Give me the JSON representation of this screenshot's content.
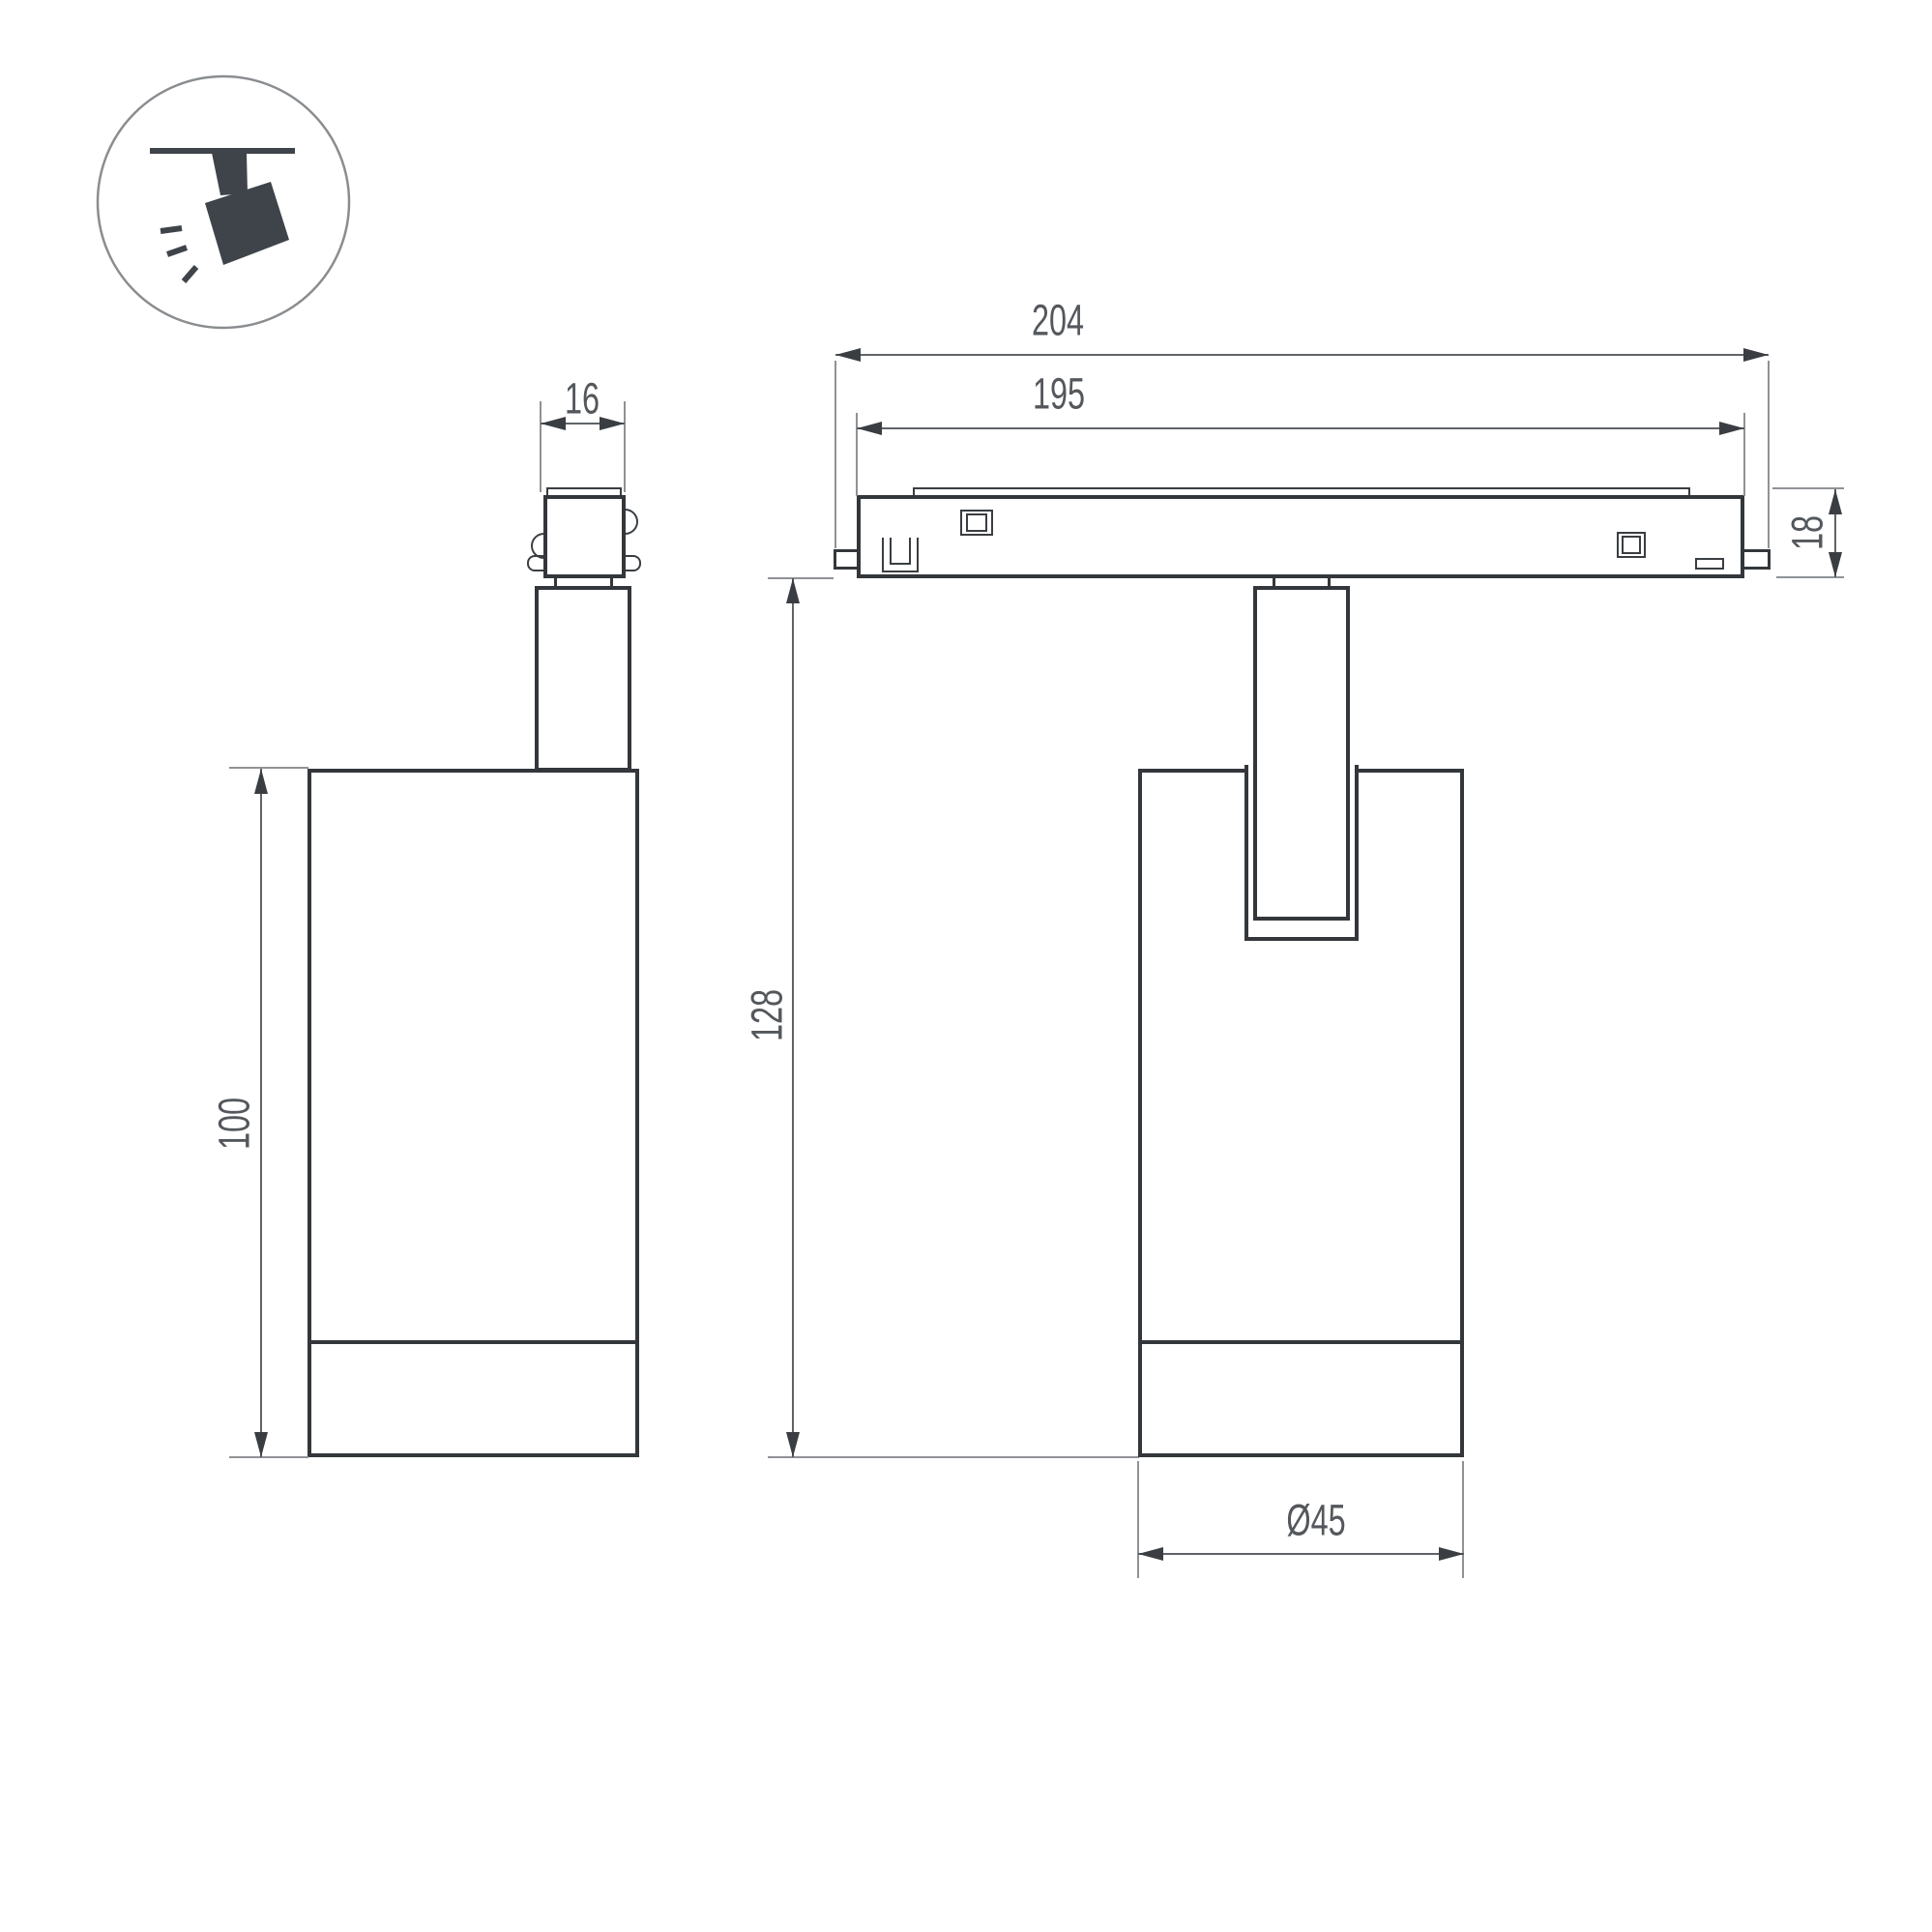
{
  "drawing": {
    "type": "luminaire-dimension-drawing",
    "views": [
      "side-view",
      "front-view-on-track"
    ]
  },
  "icon": {
    "name": "track-spotlight-icon",
    "description": "ceiling track with tilted spotlight emitting light"
  },
  "dims": {
    "adapter_width": "16",
    "body_height": "100",
    "track_total_length": "204",
    "track_body_length": "195",
    "track_height": "18",
    "overall_height": "128",
    "body_diameter": "Ø45"
  },
  "colors": {
    "outline": "#33373b",
    "detail": "#3a3e42",
    "dim_line": "#606468",
    "ext_line": "#8f9296",
    "arrow": "#3a3e42",
    "text": "#54585c",
    "icon_fill": "#3f444a",
    "icon_circle": "#8a8d90",
    "background": "#ffffff"
  }
}
